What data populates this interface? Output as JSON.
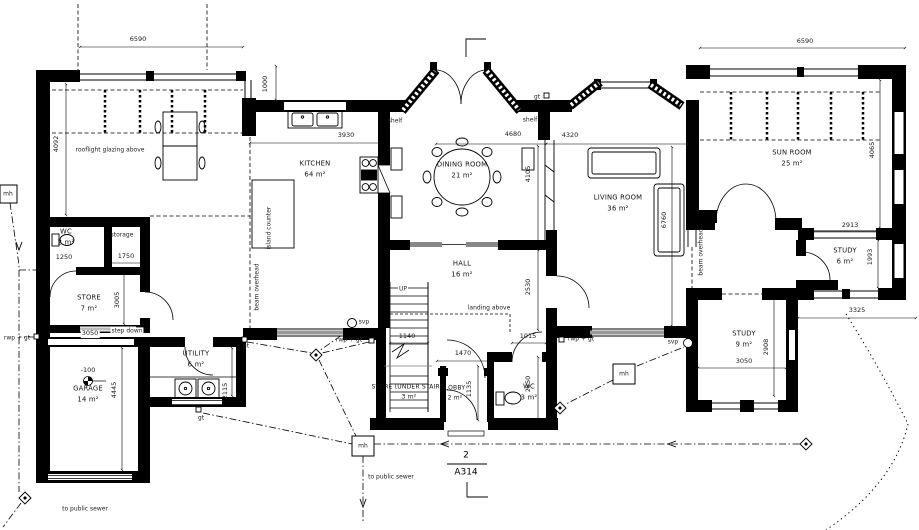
{
  "drawing": {
    "number": "2",
    "sheet": "A314"
  },
  "rooms": {
    "breakfast_note": "rooflight glazing above",
    "kitchen": {
      "name": "KITCHEN",
      "area": "64 m²"
    },
    "dining": {
      "name": "DINING ROOM",
      "area": "21 m²"
    },
    "living": {
      "name": "LIVING ROOM",
      "area": "36 m²"
    },
    "sunroom": {
      "name": "SUN ROOM",
      "area": "25 m²"
    },
    "study_small": {
      "name": "STUDY",
      "area": "6 m²"
    },
    "study_large": {
      "name": "STUDY",
      "area": "9 m²"
    },
    "hall": {
      "name": "HALL",
      "area": "16 m²"
    },
    "wc_left": {
      "name": "WC",
      "area": "2 m²"
    },
    "storage": {
      "name": "storage"
    },
    "store": {
      "name": "STORE",
      "area": "7 m²"
    },
    "garage": {
      "name": "GARAGE",
      "area": "14 m²"
    },
    "utility": {
      "name": "UTILITY",
      "area": "6 m²"
    },
    "store_under_stairs": {
      "name": "STORE (UNDER STAIRS)",
      "area": "3 m²"
    },
    "lobby": {
      "name": "LOBBY",
      "area": "2 m²"
    },
    "wc_center": {
      "name": "WC",
      "area": "3 m²"
    }
  },
  "dims": {
    "wing_top": "6590",
    "wing_return": "1000",
    "wing_side": "4092",
    "kitchen_width": "3930",
    "dining_width": "4680",
    "living_width": "4320",
    "dining_depth": "4105",
    "hall_depth": "2530",
    "living_depth": "6760",
    "sunroom_top": "6590",
    "sunroom_side": "4065",
    "study_small_width": "2913",
    "study_small_depth": "1993",
    "side_offset": "3325",
    "study_large_depth": "2908",
    "study_large_width": "3050",
    "storage_width": "1750",
    "wc_left_width": "1250",
    "store_depth": "3005",
    "store_width": "3050",
    "garage_depth": "4445",
    "utility_depth": "2115",
    "stair_width": "1140",
    "lobby_width": "1470",
    "wc_center_width": "1015",
    "wc_center_depth": "2850",
    "lobby_depth": "1135",
    "garage_level": "-100"
  },
  "annotations": {
    "island_counter": "island counter",
    "beam_overhead": "beam overhead",
    "shelf": "shelf",
    "up": "UP",
    "landing_above": "landing above",
    "step_down": "step down",
    "gt": "gt",
    "rwp_gt": "rwp + gt",
    "svp": "svp",
    "mh": "mh",
    "to_public_sewer": "to public sewer"
  }
}
